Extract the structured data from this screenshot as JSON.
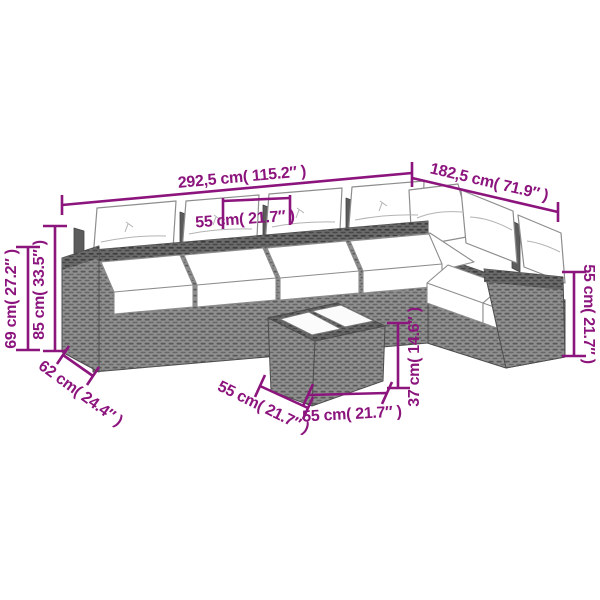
{
  "accent_color": "#8c147d",
  "figure": {
    "kind": "furniture-dimension-diagram",
    "labels": {
      "top_width": "292,5 cm( 115.2″ )",
      "top_right_depth": "182,5 cm( 71.9″ )",
      "seat_width": "55 cm( 21.7″ )",
      "left_height_outer": "69 cm( 27.2″ )",
      "left_height_inner": "85 cm( 33.5″ )",
      "left_depth": "62 cm( 24.4″ )",
      "table_side_width": "55 cm( 21.7″ )",
      "table_front_width": "55 cm( 21.7″ )",
      "table_height": "37 cm( 14.6″ )",
      "right_height": "55 cm( 21.7″ )"
    }
  }
}
